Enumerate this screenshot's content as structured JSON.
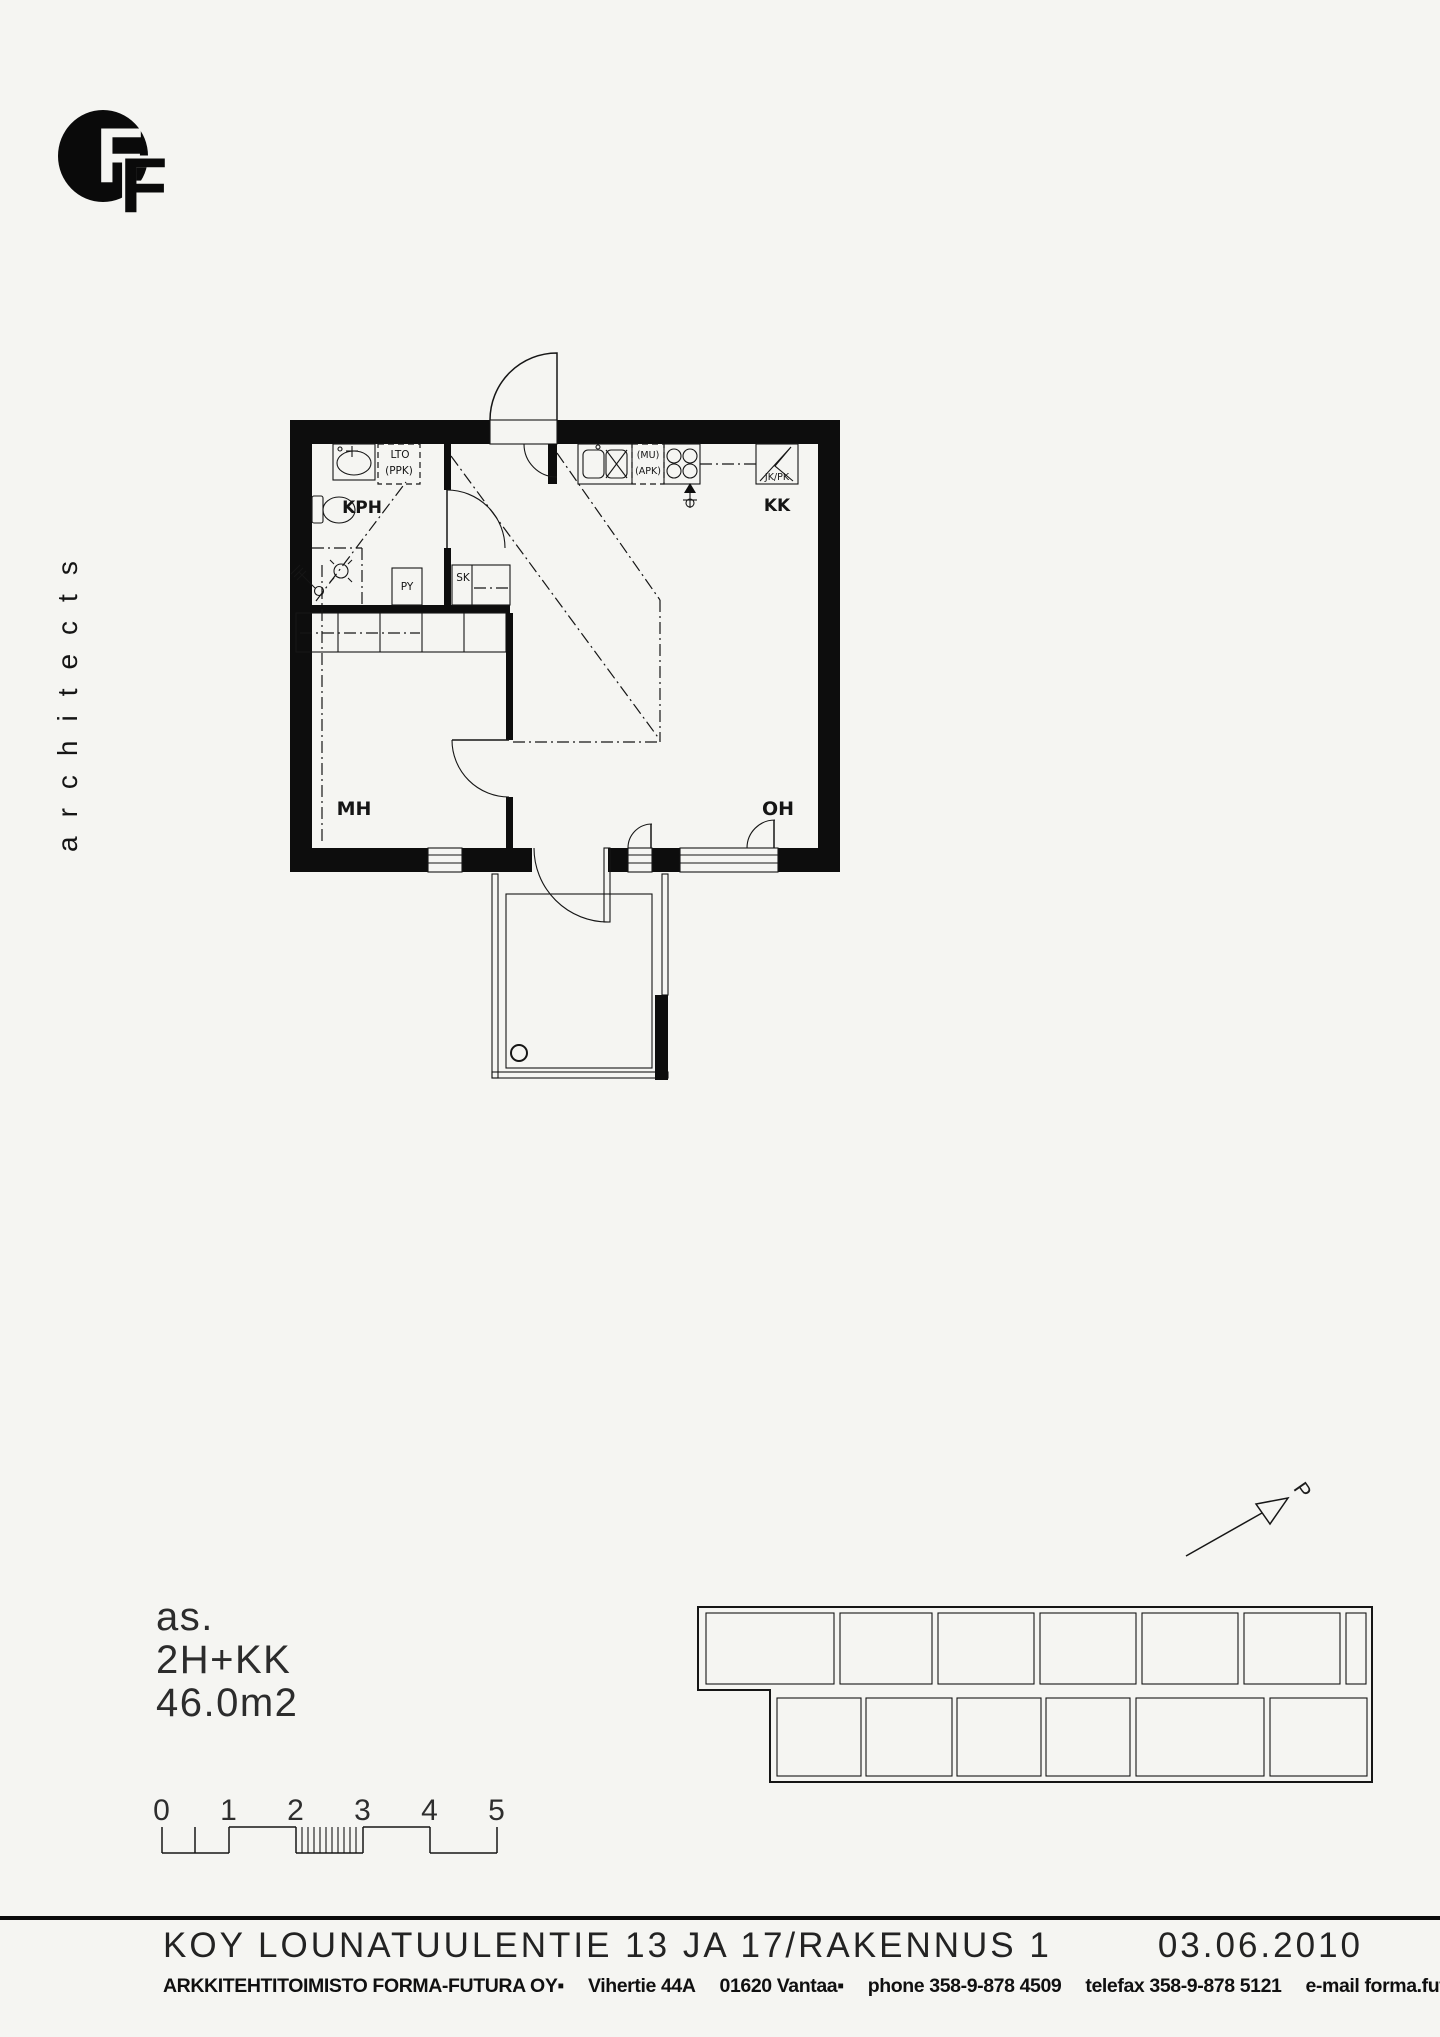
{
  "page": {
    "paper_color": "#f5f5f2",
    "ink_color": "#161616"
  },
  "logo": {
    "letter_primary": "F",
    "letter_secondary": "F"
  },
  "brand": {
    "vertical_text": "architects"
  },
  "floor_plan": {
    "room_labels": {
      "bathroom": "KPH",
      "kitchen": "KK",
      "bedroom": "MH",
      "living_room": "OH"
    },
    "fixture_labels": {
      "heat_recovery": "LTO",
      "washer_reservation": "(PPK)",
      "cabinet_py": "PY",
      "cabinet_sk": "SK",
      "microwave_reservation": "(MU)",
      "dishwasher_reservation": "(APK)",
      "fridge_freezer": "JK/PK"
    }
  },
  "site_plan": {
    "north_label": "P"
  },
  "apartment_info": {
    "unit_prefix": "as.",
    "layout": "2H+KK",
    "area": "46.0m2"
  },
  "scale_bar": {
    "labels": [
      "0",
      "1",
      "2",
      "3",
      "4",
      "5"
    ]
  },
  "footer": {
    "project_title": "KOY LOUNATUULENTIE 13 JA 17/RAKENNUS 1",
    "date": "03.06.2010",
    "office_segments": [
      "ARKKITEHTITOIMISTO FORMA-FUTURA OY▪",
      "Vihertie 44A",
      "01620 Vantaa▪",
      "phone 358-9-878 4509",
      "telefax 358-9-878 5121",
      "e-mail forma.futura@forma-futura.fi"
    ]
  }
}
